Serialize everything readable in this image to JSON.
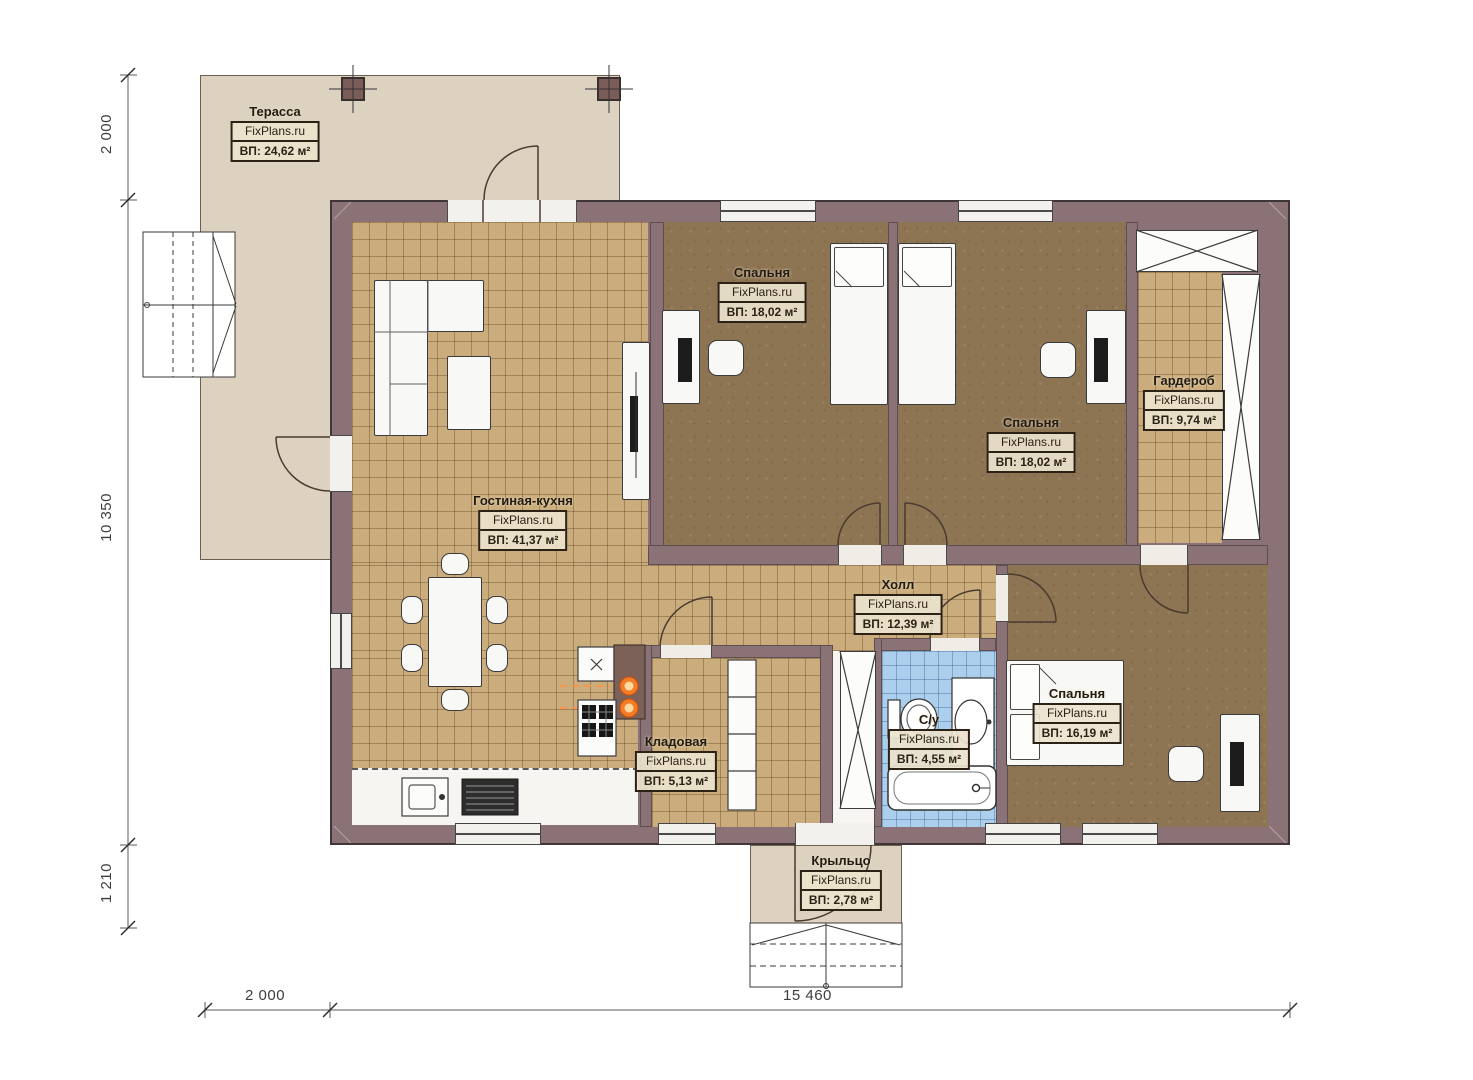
{
  "plan": {
    "brand": "FixPlans.ru",
    "rooms": [
      {
        "key": "terrace",
        "name": "Терасса",
        "brand": "FixPlans.ru",
        "area": "ВП: 24,62 м²"
      },
      {
        "key": "living-kitchen",
        "name": "Гостиная-кухня",
        "brand": "FixPlans.ru",
        "area": "ВП: 41,37 м²"
      },
      {
        "key": "bedroom-top-left",
        "name": "Спальня",
        "brand": "FixPlans.ru",
        "area": "ВП: 18,02 м²"
      },
      {
        "key": "bedroom-top-right",
        "name": "Спальня",
        "brand": "FixPlans.ru",
        "area": "ВП: 18,02 м²"
      },
      {
        "key": "wardrobe",
        "name": "Гардероб",
        "brand": "FixPlans.ru",
        "area": "ВП: 9,74 м²"
      },
      {
        "key": "hall",
        "name": "Холл",
        "brand": "FixPlans.ru",
        "area": "ВП: 12,39 м²"
      },
      {
        "key": "storage",
        "name": "Кладовая",
        "brand": "FixPlans.ru",
        "area": "ВП: 5,13 м²"
      },
      {
        "key": "bathroom",
        "name": "С/у",
        "brand": "FixPlans.ru",
        "area": "ВП: 4,55 м²"
      },
      {
        "key": "bedroom-bottom",
        "name": "Спальня",
        "brand": "FixPlans.ru",
        "area": "ВП: 16,19 м²"
      },
      {
        "key": "porch",
        "name": "Крыльцо",
        "brand": "FixPlans.ru",
        "area": "ВП: 2,78 м²"
      }
    ],
    "dimensions": {
      "left_top": "2 000",
      "left_main": "10 350",
      "left_bottom": "1 210",
      "bottom_left": "2 000",
      "bottom_main": "15 460"
    },
    "colors": {
      "wall": "#8b7276",
      "tile_floor": "#cbad7d",
      "dark_floor": "#8d7452",
      "terrace_floor": "#ddd2c0",
      "bath_floor": "#abcfec",
      "burner_accent": "#ff8125"
    }
  }
}
